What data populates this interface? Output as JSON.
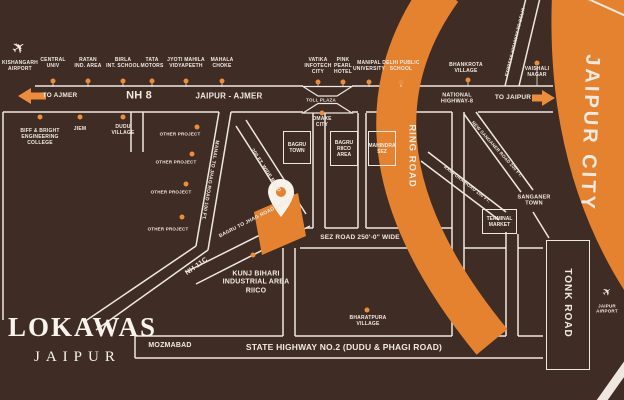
{
  "brand": {
    "name": "LOKAWAS",
    "city": "JAIPUR"
  },
  "colors": {
    "background": "#3E2C25",
    "orange": "#E5822F",
    "dot": "#EC8D3D",
    "line": "#EFE8E0",
    "text": "#F2EAE1"
  },
  "zones": {
    "jaipur_city": "JAIPUR CITY",
    "ring_road": "RING ROAD",
    "tonk_road": "TONK ROAD"
  },
  "roads": {
    "to_ajmer": "TO AJMER",
    "nh8": "NH 8",
    "jaipur_ajmer": "JAIPUR - AJMER",
    "toll_plaza": "TOLL PLAZA",
    "national_highway8": "NATIONAL\nHIGHWAY-8",
    "to_jaipur": "TO JAIPUR",
    "mahal_jhag": "MAHAL TO JHAG ROAD 100 FT.",
    "wide200": "200 FT. WIDE ROAD",
    "bagru_jhag": "BAGRU TO JHAG ROAD 200 FT.",
    "nh11c": "NH 11C",
    "sez": "SEZ ROAD 250'-0\" WIDE",
    "state_highway": "STATE HIGHWAY NO.2 (DUDU & PHAGI ROAD)",
    "new_sanganer": "NEW SANGANER ROAD 200 FT.",
    "rampura": "RAMPURA ROAD 100 FT.",
    "express_delhi": "EXPRESS HIGHWAY TO DELHI"
  },
  "landmarks": {
    "top": [
      "KISHANGARH\nAIRPORT",
      "CENTRAL\nUNIV",
      "RATAN\nIND. AREA",
      "BIRLA\nINT. SCHOOL",
      "TATA\nMOTORS",
      "JYOTI MAHILA\nVIDYAPEETH",
      "MAHALA\nCHOKE",
      "VATIKA\nINFOTECH\nCITY",
      "PINK\nPEARL\nHOTEL",
      "MANIPAL\nUNIVERSITY",
      "DELHI PUBLIC\nSCHOOL",
      "BHANKROTA\nVILLAGE",
      "VAISHALI\nNAGAR"
    ],
    "mid": [
      "BIFF & BRIGHT\nENGINEERING\nCOLLEGE",
      "JIEM",
      "DUDU\nVILLAGE",
      "OMAXE\nCITY",
      "OTHER PROJECT",
      "OTHER PROJECT",
      "OTHER PROJECT",
      "OTHER PROJECT",
      "KUNJ BIHARI\nINDUSTRIAL AREA\nRIICO",
      "BHARATPURA\nVILLAGE",
      "MOZMABAD",
      "SANGANER\nTOWN",
      "JAIPUR\nAIRPORT"
    ]
  },
  "boxes": [
    "BAGRU\nTOWN",
    "BAGRU\nRIICO\nAREA",
    "MAHINDRA\nSEZ",
    "TERMINAL\nMARKET"
  ],
  "icons": {
    "airplane": "✈"
  }
}
